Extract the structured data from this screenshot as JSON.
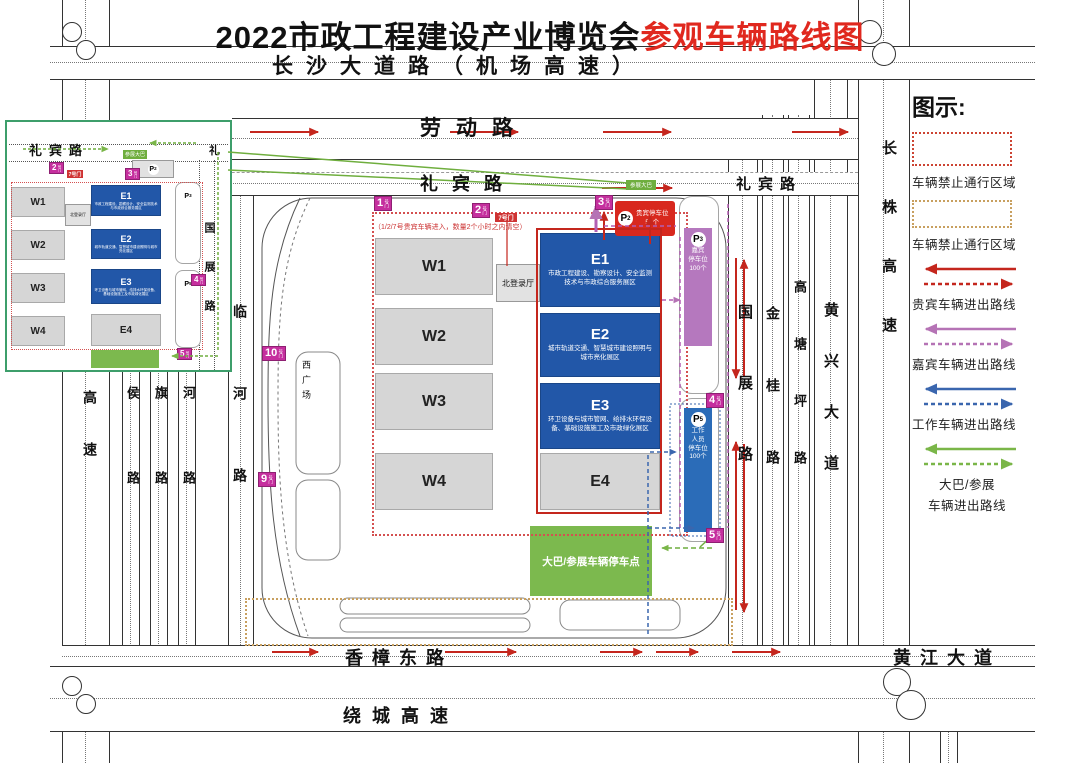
{
  "title": {
    "main": "2022市政工程建设产业博览会",
    "highlight": "参观车辆路线图"
  },
  "roads": {
    "changsha": "长沙大道路（机场高速）",
    "laodong": "劳动路",
    "libin": "礼宾路",
    "libin_char": "礼",
    "xiangzhang": "香樟东路",
    "huangjiang": "黄江大道",
    "raocheng": "绕城高速",
    "guozhan": "国展路",
    "jingui": "金桂路",
    "gaotangping": "高塘坪路",
    "huangxing": "黄兴大道",
    "changzhu": "长株高速",
    "linhe": "临河路",
    "gaosu": "高速",
    "houlu": "侯路",
    "qilu": "旗路",
    "helu": "河路"
  },
  "halls": {
    "w": [
      "W1",
      "W2",
      "W3",
      "W4"
    ],
    "e": [
      {
        "label": "E1",
        "desc": "市政工程建设、勘察设计、安全监测技术与市政综合服务展区"
      },
      {
        "label": "E2",
        "desc": "城市轨道交通、智慧城市建设照明与城市亮化展区"
      },
      {
        "label": "E3",
        "desc": "环卫设备与城市管网、给排水环保设备、基础设施施工及市政绿化展区"
      },
      {
        "label": "E4",
        "desc": ""
      }
    ],
    "north_hall": "北登录厅",
    "west_plaza": "西广场",
    "bus_area": "大巴/参展车辆停车点"
  },
  "parking": {
    "p2": {
      "letter": "P",
      "sub": "2",
      "text": "贵宾停车位\n50个"
    },
    "p3": {
      "letter": "P",
      "sub": "3",
      "text": "嘉宾\n停车位\n100个"
    },
    "p5": {
      "letter": "P",
      "sub": "5",
      "text": "工作\n人员\n停车位\n100个"
    }
  },
  "gates": {
    "suffix": "号门",
    "g1": "1",
    "g2": "2",
    "g3": "3",
    "g4": "4",
    "g5": "5",
    "g9": "9",
    "g10": "10",
    "i2": "2",
    "i3": "3",
    "i4": "4",
    "i5": "5"
  },
  "notes": {
    "vip": "（1/2/7号贵宾车辆进入，数量2个小时之内清空）",
    "gate7": "7号门",
    "bus": "参展大巴"
  },
  "legend": {
    "title": "图示:",
    "items": [
      {
        "label": "车辆禁止通行区域",
        "color": "#cc4433",
        "style": "dotted-rect"
      },
      {
        "label": "车辆禁止通行区域",
        "color": "#c8a060",
        "style": "dotted-rect"
      },
      {
        "label": "贵宾车辆进出路线",
        "color": "#c4261d",
        "style": "arrows"
      },
      {
        "label": "嘉宾车辆进出路线",
        "color": "#b573b5",
        "style": "arrows"
      },
      {
        "label": "工作车辆进出路线",
        "color": "#3a66ae",
        "style": "arrows"
      },
      {
        "label": "大巴/参展",
        "label2": "车辆进出路线",
        "color": "#7ab648",
        "style": "arrows"
      }
    ]
  }
}
